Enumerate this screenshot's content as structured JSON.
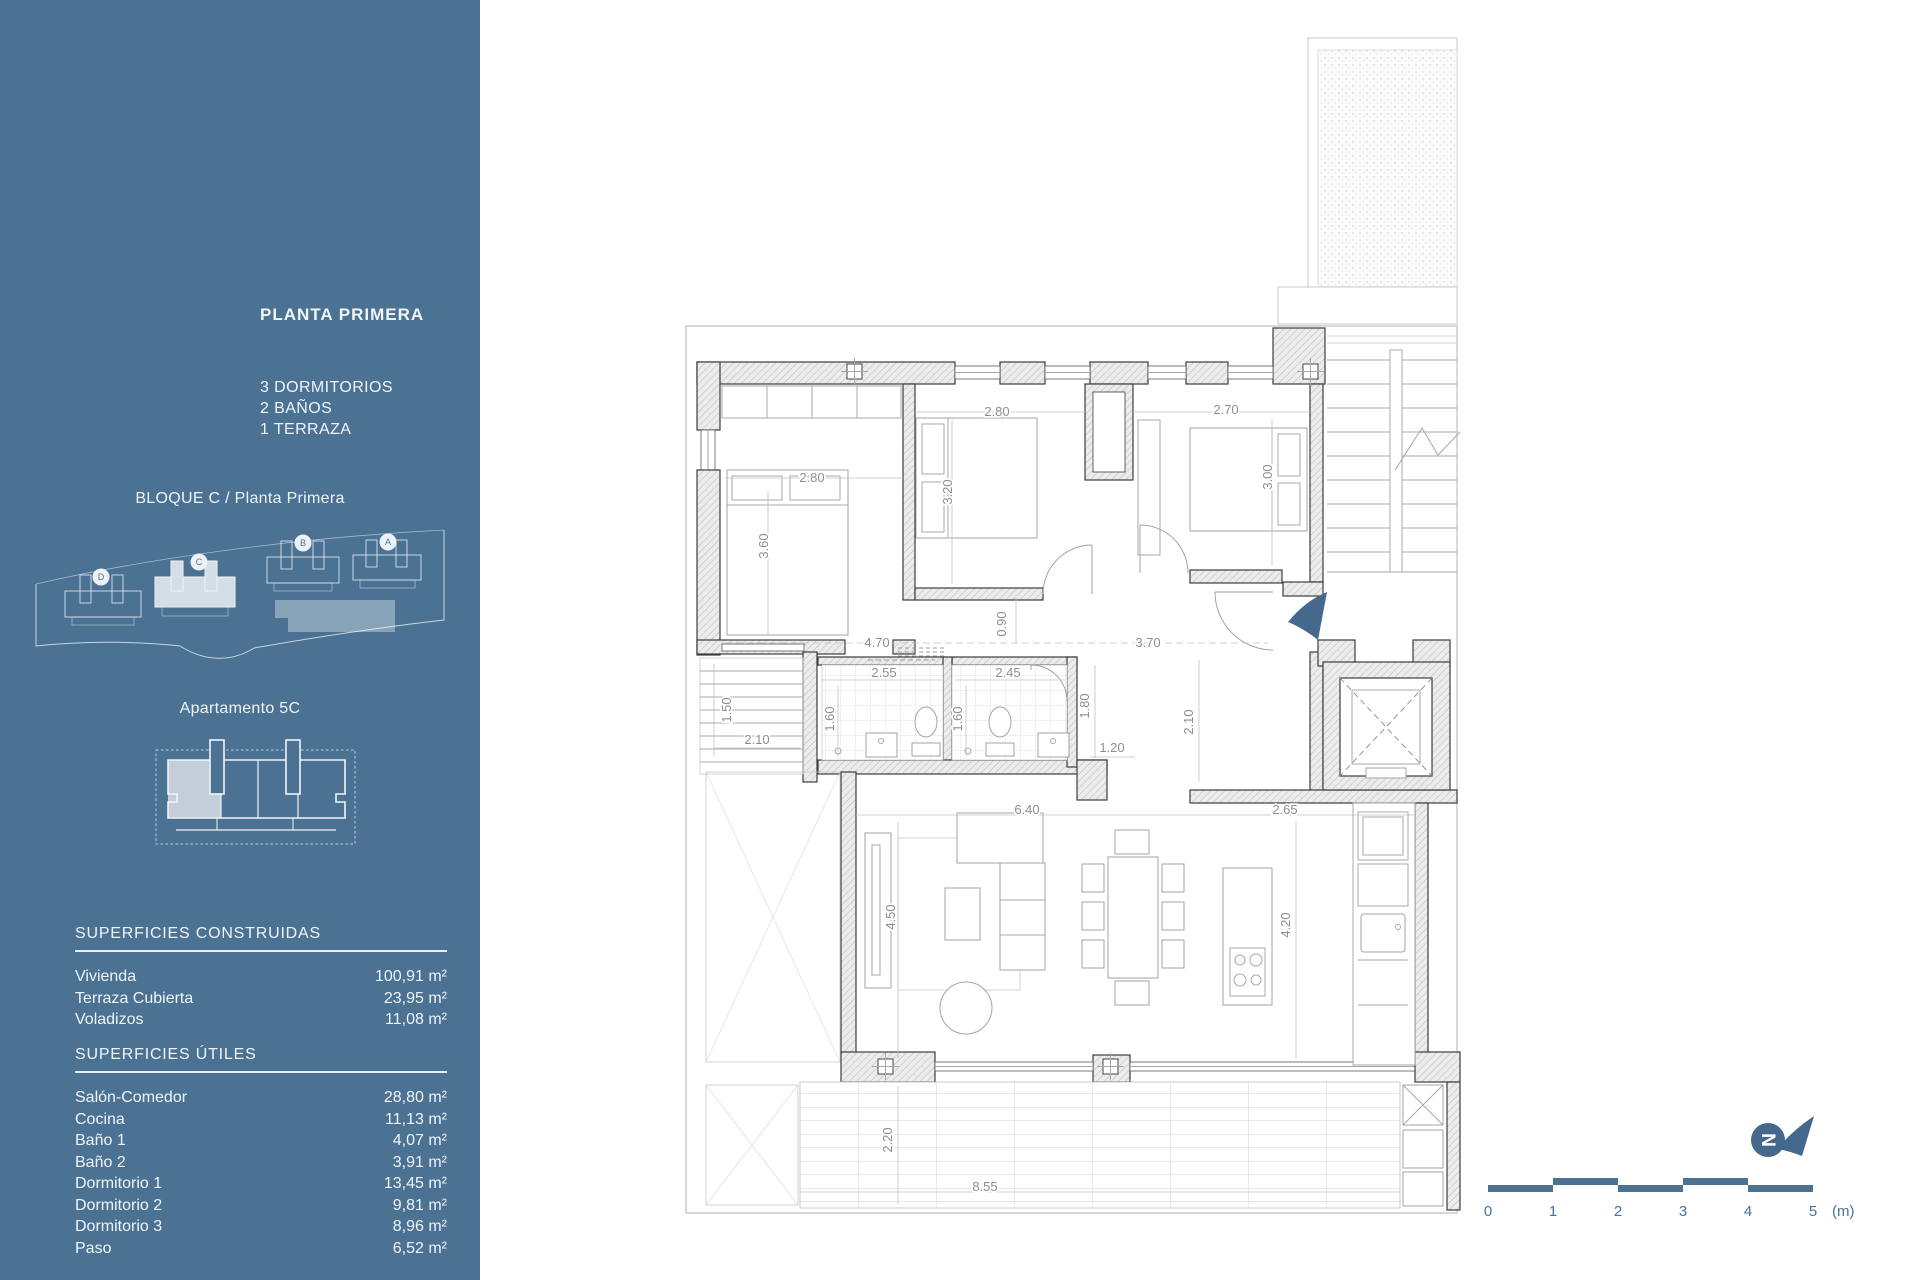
{
  "sidebar": {
    "title": "PLANTA PRIMERA",
    "program": [
      "3 DORMITORIOS",
      "2 BAÑOS",
      "1 TERRAZA"
    ],
    "block_caption": "BLOQUE C / Planta Primera",
    "apartment_caption": "Apartamento 5C",
    "site_blocks": [
      {
        "label": "D",
        "cx": 71,
        "cy": 55
      },
      {
        "label": "C",
        "cx": 169,
        "cy": 40
      },
      {
        "label": "B",
        "cx": 273,
        "cy": 21
      },
      {
        "label": "A",
        "cx": 358,
        "cy": 20
      }
    ],
    "tables": [
      {
        "title": "SUPERFICIES CONSTRUIDAS",
        "rows": [
          [
            "Vivienda",
            "100,91 m²"
          ],
          [
            "Terraza Cubierta",
            "23,95 m²"
          ],
          [
            "Voladizos",
            "11,08 m²"
          ]
        ]
      },
      {
        "title": "SUPERFICIES ÚTILES",
        "rows": [
          [
            "Salón-Comedor",
            "28,80 m²"
          ],
          [
            "Cocina",
            "11,13 m²"
          ],
          [
            "Baño 1",
            "4,07 m²"
          ],
          [
            "Baño 2",
            "3,91 m²"
          ],
          [
            "Dormitorio 1",
            "13,45 m²"
          ],
          [
            "Dormitorio 2",
            "9,81 m²"
          ],
          [
            "Dormitorio 3",
            "8,96 m²"
          ],
          [
            "Paso",
            "6,52 m²"
          ]
        ]
      }
    ]
  },
  "floor_plan": {
    "dimension_labels": [
      {
        "text": "2.80",
        "x": 812,
        "y": 482
      },
      {
        "text": "3.60",
        "x": 768,
        "y": 546,
        "rot": 1
      },
      {
        "text": "2.80",
        "x": 997,
        "y": 416
      },
      {
        "text": "3.20",
        "x": 952,
        "y": 492,
        "rot": 1
      },
      {
        "text": "2.70",
        "x": 1226,
        "y": 414
      },
      {
        "text": "3.00",
        "x": 1272,
        "y": 477,
        "rot": 1
      },
      {
        "text": "4.70",
        "x": 877,
        "y": 647
      },
      {
        "text": "0.90",
        "x": 1006,
        "y": 624,
        "rot": 1
      },
      {
        "text": "3.70",
        "x": 1148,
        "y": 647
      },
      {
        "text": "1.50",
        "x": 731,
        "y": 710,
        "rot": 1
      },
      {
        "text": "2.10",
        "x": 757,
        "y": 744
      },
      {
        "text": "2.55",
        "x": 884,
        "y": 677
      },
      {
        "text": "1.60",
        "x": 834,
        "y": 719,
        "rot": 1
      },
      {
        "text": "2.45",
        "x": 1008,
        "y": 677
      },
      {
        "text": "1.60",
        "x": 962,
        "y": 719,
        "rot": 1
      },
      {
        "text": "1.80",
        "x": 1089,
        "y": 706,
        "rot": 1
      },
      {
        "text": "1.20",
        "x": 1112,
        "y": 752
      },
      {
        "text": "2.10",
        "x": 1193,
        "y": 722,
        "rot": 1
      },
      {
        "text": "6.40",
        "x": 1027,
        "y": 814
      },
      {
        "text": "2.65",
        "x": 1285,
        "y": 814
      },
      {
        "text": "4.50",
        "x": 895,
        "y": 917,
        "rot": 1
      },
      {
        "text": "4.20",
        "x": 1290,
        "y": 925,
        "rot": 1
      },
      {
        "text": "2.20",
        "x": 892,
        "y": 1140,
        "rot": 1
      },
      {
        "text": "8.55",
        "x": 985,
        "y": 1191
      }
    ],
    "north_label": "N",
    "scale_bar": {
      "ticks": [
        "0",
        "1",
        "2",
        "3",
        "4",
        "5"
      ],
      "unit": "(m)"
    }
  },
  "colors": {
    "sidebar_bg": "#4B7293",
    "accent": "#44698D",
    "highlight": "#C3CEDA"
  }
}
